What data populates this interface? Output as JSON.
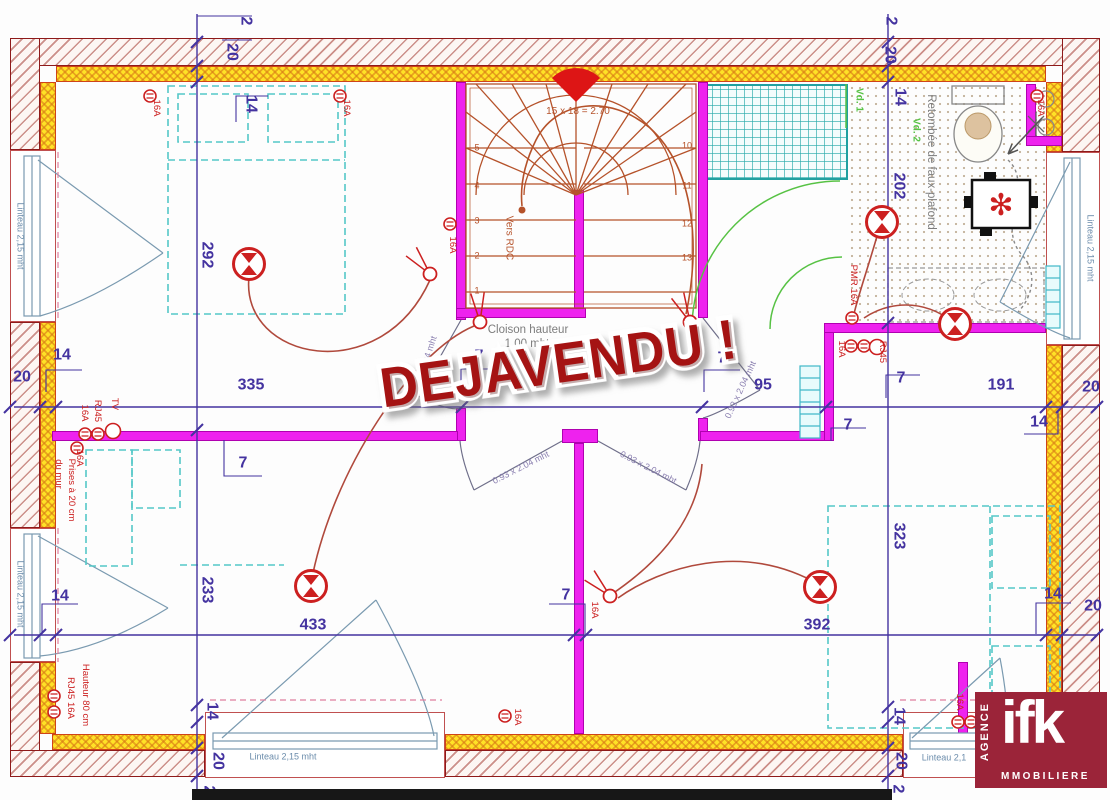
{
  "stamp": {
    "text": "DEJAVENDU !"
  },
  "logo": {
    "vertical": "AGENCE",
    "brand": "ifk",
    "bottom": "MMOBILIERE"
  },
  "colors": {
    "wall": "#8e1a1a",
    "insulation": "#ffe226",
    "partition": "#ee22ee",
    "dimension": "#4433a0",
    "electric": "#cc2020",
    "furniture": "#55c8c8",
    "stair": "#b5522a",
    "green": "#57c244",
    "stamp": "#a51313",
    "logo_bg": "#9b2439"
  },
  "labels": [
    {
      "t": "2",
      "x": 245,
      "y": 21,
      "r": 90,
      "c": "dim"
    },
    {
      "t": "20",
      "x": 231,
      "y": 52,
      "r": 90,
      "c": "dim"
    },
    {
      "t": "14",
      "x": 250,
      "y": 104,
      "r": 90,
      "c": "dim"
    },
    {
      "t": "292",
      "x": 206,
      "y": 255,
      "r": 90,
      "c": "dim"
    },
    {
      "t": "2",
      "x": 890,
      "y": 21,
      "r": 90,
      "c": "dim"
    },
    {
      "t": "20",
      "x": 889,
      "y": 55,
      "r": 90,
      "c": "dim"
    },
    {
      "t": "14",
      "x": 899,
      "y": 97,
      "r": 90,
      "c": "dim"
    },
    {
      "t": "202",
      "x": 898,
      "y": 186,
      "r": 90,
      "c": "dim"
    },
    {
      "t": "20",
      "x": 22,
      "y": 378,
      "r": 0,
      "c": "dim"
    },
    {
      "t": "14",
      "x": 62,
      "y": 356,
      "r": 0,
      "c": "dim"
    },
    {
      "t": "335",
      "x": 251,
      "y": 386,
      "r": 0,
      "c": "dim"
    },
    {
      "t": "7",
      "x": 479,
      "y": 357,
      "r": 0,
      "c": "dim"
    },
    {
      "t": "7",
      "x": 722,
      "y": 359,
      "r": 0,
      "c": "dim"
    },
    {
      "t": "95",
      "x": 763,
      "y": 386,
      "r": 0,
      "c": "dim"
    },
    {
      "t": "7",
      "x": 901,
      "y": 379,
      "r": 0,
      "c": "dim"
    },
    {
      "t": "191",
      "x": 1001,
      "y": 386,
      "r": 0,
      "c": "dim"
    },
    {
      "t": "20",
      "x": 1091,
      "y": 388,
      "r": 0,
      "c": "dim"
    },
    {
      "t": "14",
      "x": 1039,
      "y": 423,
      "r": 0,
      "c": "dim"
    },
    {
      "t": "7",
      "x": 848,
      "y": 426,
      "r": 0,
      "c": "dim"
    },
    {
      "t": "7",
      "x": 243,
      "y": 464,
      "r": 0,
      "c": "dim"
    },
    {
      "t": "233",
      "x": 206,
      "y": 590,
      "r": 90,
      "c": "dim"
    },
    {
      "t": "433",
      "x": 313,
      "y": 626,
      "r": 0,
      "c": "dim"
    },
    {
      "t": "7",
      "x": 566,
      "y": 596,
      "r": 0,
      "c": "dim"
    },
    {
      "t": "392",
      "x": 817,
      "y": 626,
      "r": 0,
      "c": "dim"
    },
    {
      "t": "323",
      "x": 898,
      "y": 536,
      "r": 90,
      "c": "dim"
    },
    {
      "t": "14",
      "x": 60,
      "y": 597,
      "r": 0,
      "c": "dim"
    },
    {
      "t": "14",
      "x": 1053,
      "y": 595,
      "r": 0,
      "c": "dim"
    },
    {
      "t": "20",
      "x": 1093,
      "y": 607,
      "r": 0,
      "c": "dim"
    },
    {
      "t": "14",
      "x": 211,
      "y": 711,
      "r": 90,
      "c": "dim"
    },
    {
      "t": "20",
      "x": 217,
      "y": 761,
      "r": 90,
      "c": "dim"
    },
    {
      "t": "2",
      "x": 208,
      "y": 790,
      "r": 90,
      "c": "dim"
    },
    {
      "t": "14",
      "x": 898,
      "y": 716,
      "r": 90,
      "c": "dim"
    },
    {
      "t": "20",
      "x": 900,
      "y": 761,
      "r": 90,
      "c": "dim"
    },
    {
      "t": "2",
      "x": 897,
      "y": 789,
      "r": 90,
      "c": "dim"
    },
    {
      "t": "16A",
      "x": 156,
      "y": 108,
      "r": 90,
      "c": "elec"
    },
    {
      "t": "16A",
      "x": 346,
      "y": 108,
      "r": 90,
      "c": "elec"
    },
    {
      "t": "16A",
      "x": 1040,
      "y": 108,
      "r": 90,
      "c": "elec"
    },
    {
      "t": "16A",
      "x": 452,
      "y": 245,
      "r": 90,
      "c": "elec"
    },
    {
      "t": "TV",
      "x": 114,
      "y": 404,
      "r": 90,
      "c": "elec"
    },
    {
      "t": "RJ45",
      "x": 97,
      "y": 411,
      "r": 90,
      "c": "elec"
    },
    {
      "t": "16A",
      "x": 84,
      "y": 413,
      "r": 90,
      "c": "elec"
    },
    {
      "t": "16A",
      "x": 79,
      "y": 458,
      "r": 90,
      "c": "elec"
    },
    {
      "t": "Prises à 20 cm",
      "x": 71,
      "y": 490,
      "r": 90,
      "c": "elec"
    },
    {
      "t": "du mur",
      "x": 58,
      "y": 474,
      "r": 90,
      "c": "elec"
    },
    {
      "t": "Hauteur 80 cm",
      "x": 85,
      "y": 695,
      "r": 90,
      "c": "elec"
    },
    {
      "t": "RJ45 16A",
      "x": 70,
      "y": 698,
      "r": 90,
      "c": "elec"
    },
    {
      "t": "PMR 16A",
      "x": 853,
      "y": 285,
      "r": 90,
      "c": "elec"
    },
    {
      "t": "16A",
      "x": 841,
      "y": 349,
      "r": 90,
      "c": "elec"
    },
    {
      "t": "RJ45",
      "x": 882,
      "y": 352,
      "r": 90,
      "c": "elec"
    },
    {
      "t": "16A",
      "x": 594,
      "y": 610,
      "r": 90,
      "c": "elec"
    },
    {
      "t": "16A",
      "x": 959,
      "y": 702,
      "r": 90,
      "c": "elec"
    },
    {
      "t": "16A",
      "x": 517,
      "y": 717,
      "r": 90,
      "c": "elec"
    },
    {
      "t": "Cloison hauteur",
      "x": 528,
      "y": 330,
      "r": 0,
      "c": "note"
    },
    {
      "t": "1,00 mht",
      "x": 527,
      "y": 344,
      "r": 0,
      "c": "note"
    },
    {
      "t": "Retombée de faux-plafond",
      "x": 931,
      "y": 162,
      "r": 90,
      "c": "note"
    },
    {
      "t": "Vers RDC",
      "x": 508,
      "y": 238,
      "r": 90,
      "c": "stairtxt"
    },
    {
      "t": "15 x 18 = 2.70",
      "x": 578,
      "y": 112,
      "r": 0,
      "c": "stairtxt"
    },
    {
      "t": "Vd. 1",
      "x": 858,
      "y": 100,
      "r": 90,
      "c": "green"
    },
    {
      "t": "Vd. 2",
      "x": 915,
      "y": 130,
      "r": 90,
      "c": "green"
    },
    {
      "t": "Linteau 2,15 mht",
      "x": 20,
      "y": 236,
      "r": 90,
      "c": "lintel"
    },
    {
      "t": "Linteau 2,15 mht",
      "x": 20,
      "y": 594,
      "r": 90,
      "c": "lintel"
    },
    {
      "t": "Linteau 2,15 mht",
      "x": 1090,
      "y": 248,
      "r": 90,
      "c": "lintel"
    },
    {
      "t": "Linteau 2,15 mht",
      "x": 283,
      "y": 757,
      "r": 0,
      "c": "lintel"
    },
    {
      "t": "Linteau 2,1",
      "x": 944,
      "y": 758,
      "r": 0,
      "c": "lintel"
    },
    {
      "t": "0.93 x 2.04 mht",
      "x": 521,
      "y": 468,
      "r": -27,
      "c": "door"
    },
    {
      "t": "0.93 x 2.04 mht",
      "x": 648,
      "y": 468,
      "r": 27,
      "c": "door"
    },
    {
      "t": "0.93 x 2.04 mht",
      "x": 425,
      "y": 366,
      "r": -72,
      "c": "door"
    },
    {
      "t": "0.93 x 2.04 mht",
      "x": 741,
      "y": 390,
      "r": -65,
      "c": "door"
    },
    {
      "t": "1",
      "x": 477,
      "y": 291,
      "r": 0,
      "c": "stairnum"
    },
    {
      "t": "2",
      "x": 477,
      "y": 256,
      "r": 0,
      "c": "stairnum"
    },
    {
      "t": "3",
      "x": 477,
      "y": 221,
      "r": 0,
      "c": "stairnum"
    },
    {
      "t": "4",
      "x": 477,
      "y": 186,
      "r": 0,
      "c": "stairnum"
    },
    {
      "t": "5",
      "x": 477,
      "y": 148,
      "r": 0,
      "c": "stairnum"
    },
    {
      "t": "10",
      "x": 687,
      "y": 146,
      "r": 0,
      "c": "stairnum"
    },
    {
      "t": "11",
      "x": 687,
      "y": 186,
      "r": 0,
      "c": "stairnum"
    },
    {
      "t": "12",
      "x": 687,
      "y": 224,
      "r": 0,
      "c": "stairnum"
    },
    {
      "t": "13",
      "x": 687,
      "y": 258,
      "r": 0,
      "c": "stairnum"
    }
  ],
  "electric": {
    "lights": [
      [
        249,
        264
      ],
      [
        882,
        222
      ],
      [
        955,
        324
      ],
      [
        311,
        586
      ],
      [
        820,
        587
      ]
    ],
    "stair_light": [
      575,
      92
    ],
    "sockets": [
      [
        150,
        96
      ],
      [
        340,
        96
      ],
      [
        1037,
        96
      ],
      [
        450,
        224
      ],
      [
        85,
        434
      ],
      [
        98,
        434
      ],
      [
        77,
        448
      ],
      [
        54,
        696
      ],
      [
        54,
        712
      ],
      [
        852,
        318
      ],
      [
        851,
        346
      ],
      [
        864,
        346
      ],
      [
        958,
        722
      ],
      [
        971,
        722
      ],
      [
        505,
        716
      ]
    ],
    "tv_outlets": [
      [
        113,
        431
      ],
      [
        877,
        347
      ]
    ],
    "switches": [
      {
        "x": 430,
        "y": 274,
        "a": 130
      },
      {
        "x": 480,
        "y": 322,
        "a": 95
      },
      {
        "x": 690,
        "y": 322,
        "a": 115
      },
      {
        "x": 610,
        "y": 596,
        "a": 135
      }
    ]
  },
  "dim_ticks": [
    [
      197,
      42
    ],
    [
      197,
      66
    ],
    [
      197,
      82
    ],
    [
      197,
      430
    ],
    [
      197,
      705
    ],
    [
      197,
      722
    ],
    [
      197,
      748
    ],
    [
      197,
      776
    ],
    [
      888,
      42
    ],
    [
      888,
      66
    ],
    [
      888,
      82
    ],
    [
      888,
      323
    ],
    [
      888,
      707
    ],
    [
      888,
      722
    ],
    [
      888,
      748
    ],
    [
      888,
      776
    ],
    [
      10,
      407
    ],
    [
      40,
      407
    ],
    [
      56,
      407
    ],
    [
      462,
      407
    ],
    [
      702,
      407
    ],
    [
      826,
      407
    ],
    [
      1046,
      407
    ],
    [
      1062,
      407
    ],
    [
      1097,
      407
    ],
    [
      10,
      635
    ],
    [
      40,
      635
    ],
    [
      56,
      635
    ],
    [
      574,
      635
    ],
    [
      586,
      635
    ],
    [
      1046,
      635
    ],
    [
      1062,
      635
    ],
    [
      1097,
      635
    ]
  ]
}
